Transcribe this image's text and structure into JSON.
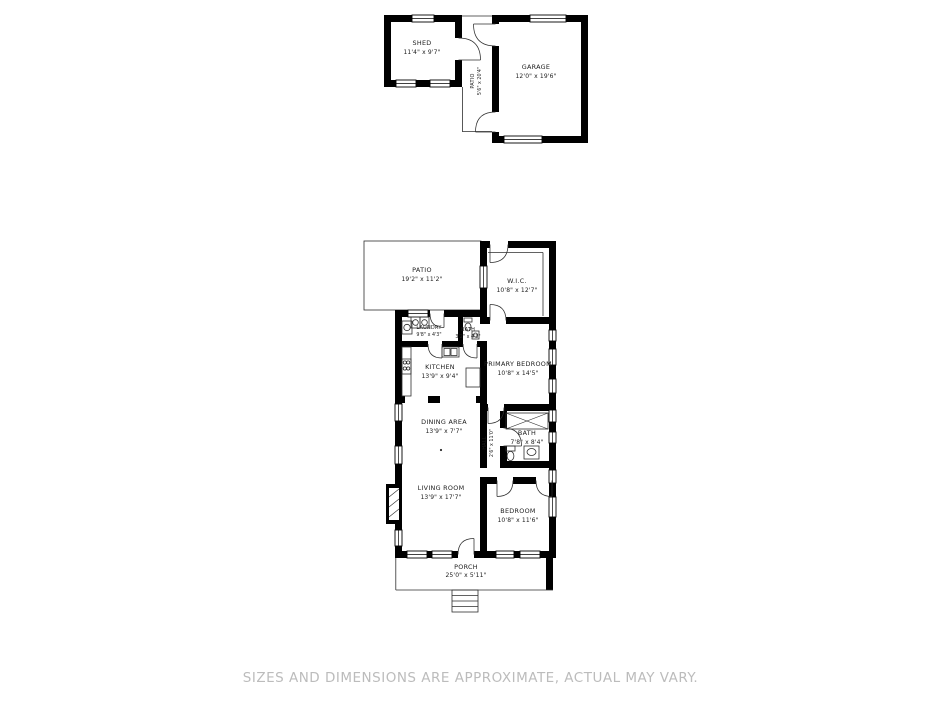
{
  "background": "#ffffff",
  "palette": {
    "wall": "#000000",
    "thin_line": "#2e2e2e",
    "label": "#1c1c1c",
    "disclaimer_text": "#bcbcbc"
  },
  "disclaimer": "SIZES AND DIMENSIONS ARE APPROXIMATE, ACTUAL MAY VARY.",
  "outbuilding": {
    "shed": {
      "name": "SHED",
      "dims": "11'4\" x 9'7\""
    },
    "patio": {
      "name": "PATIO",
      "dims": "5'6\" x 20'4\""
    },
    "garage": {
      "name": "GARAGE",
      "dims": "12'0\" x 19'6\""
    }
  },
  "house": {
    "patio": {
      "name": "PATIO",
      "dims": "19'2\" x 11'2\""
    },
    "wic": {
      "name": "W.I.C.",
      "dims": "10'8\" x 12'7\""
    },
    "laundry": {
      "name": "LAUNDRY",
      "dims": "9'8\" x 4'3\""
    },
    "bath_small": {
      "name": "BATH",
      "dims": "3'2\" x 4'3\""
    },
    "kitchen": {
      "name": "KITCHEN",
      "dims": "13'9\" x 9'4\""
    },
    "primary_bedroom": {
      "name": "PRIMARY BEDROOM",
      "dims": "10'8\" x 14'5\""
    },
    "dining": {
      "name": "DINING AREA",
      "dims": "13'9\" x 7'7\""
    },
    "hall": {
      "name": "HALL",
      "dims": "2'6\" x 11'0\""
    },
    "bath": {
      "name": "BATH",
      "dims": "7'8\" x 8'4\""
    },
    "living": {
      "name": "LIVING ROOM",
      "dims": "13'9\" x 17'7\""
    },
    "bedroom": {
      "name": "BEDROOM",
      "dims": "10'8\" x 11'6\""
    },
    "porch": {
      "name": "PORCH",
      "dims": "25'0\" x 5'11\""
    }
  }
}
